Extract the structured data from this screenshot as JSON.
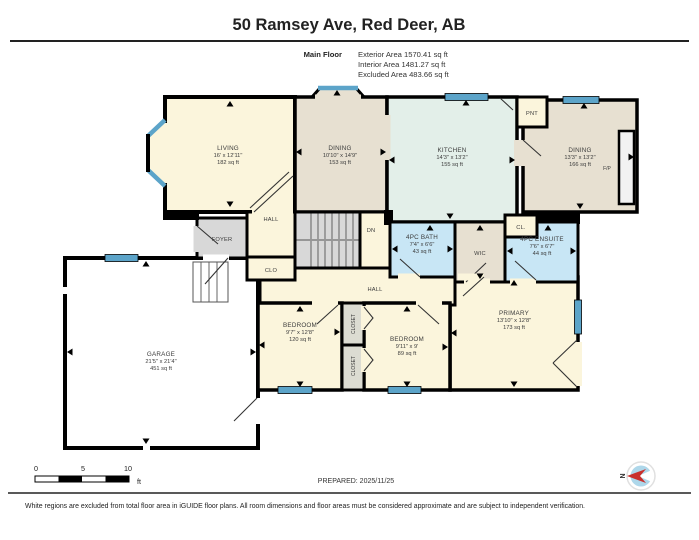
{
  "header": {
    "title": "50 Ramsey Ave, Red Deer, AB",
    "floor_label": "Main Floor",
    "stats": {
      "exterior": "Exterior Area 1570.41 sq ft",
      "interior": "Interior Area 1481.27 sq ft",
      "excluded": "Excluded Area 483.66 sq ft"
    }
  },
  "rooms": {
    "living": {
      "name": "LIVING",
      "dims": "16' x 12'11\"",
      "area": "182 sq ft"
    },
    "dining_front": {
      "name": "DINING",
      "dims": "10'10\" x 14'9\"",
      "area": "153 sq ft"
    },
    "kitchen": {
      "name": "KITCHEN",
      "dims": "14'3\" x 13'2\"",
      "area": "155 sq ft"
    },
    "dining_rear": {
      "name": "DINING",
      "dims": "13'3\" x 13'2\"",
      "area": "166 sq ft"
    },
    "bath": {
      "name": "4PC BATH",
      "dims": "7'4\" x 6'6\"",
      "area": "43 sq ft"
    },
    "ensuite": {
      "name": "4PC ENSUITE",
      "dims": "7'6\" x 6'7\"",
      "area": "44 sq ft"
    },
    "bedroom_left": {
      "name": "BEDROOM",
      "dims": "9'7\" x 12'8\"",
      "area": "120 sq ft"
    },
    "bedroom_mid": {
      "name": "BEDROOM",
      "dims": "9'11\" x 9'",
      "area": "89 sq ft"
    },
    "primary": {
      "name": "PRIMARY",
      "dims": "13'10\" x 12'8\"",
      "area": "173 sq ft"
    },
    "garage": {
      "name": "GARAGE",
      "dims": "21'5\" x 21'4\"",
      "area": "451 sq ft"
    }
  },
  "labels": {
    "foyer": "FOYER",
    "hall_upper": "HALL",
    "hall_lower": "HALL",
    "clo": "CLO",
    "dn": "DN",
    "wic": "WIC",
    "cl": "CL.",
    "pnt": "PNT",
    "fp": "F/P",
    "closet_upper": "CLOSET",
    "closet_lower": "CLOSET"
  },
  "footer": {
    "scale_ticks": [
      "0",
      "5",
      "10"
    ],
    "scale_unit": "ft",
    "prepared": "PREPARED: 2025/11/25",
    "compass": "N",
    "disclaimer": "White regions are excluded from total floor area in iGUIDE floor plans. All room dimensions and floor areas must be considered approximate and are subject to independent verification."
  },
  "colors": {
    "room_cream": "#fbf5dc",
    "room_tan": "#e7e0d1",
    "room_mint": "#e3efe9",
    "room_blue": "#c8e6f5",
    "room_gray": "#d8d8d8",
    "closet_gray": "#dcdcd2",
    "window_blue": "#5ca4c9",
    "wall_black": "#000000",
    "compass_red": "#c9302c"
  }
}
